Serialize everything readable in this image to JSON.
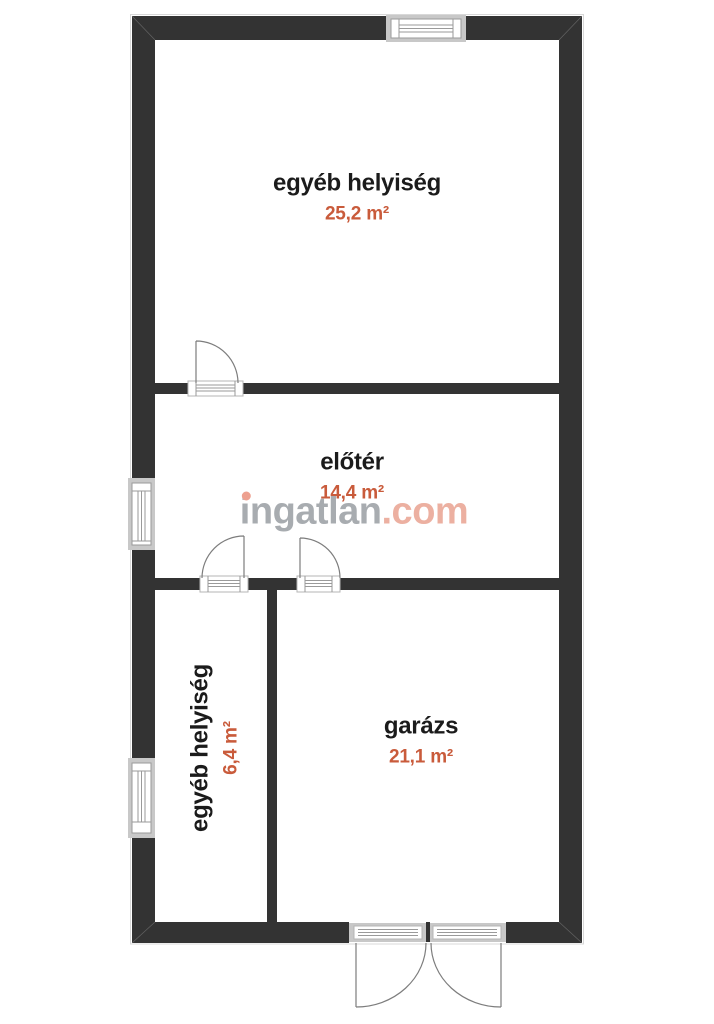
{
  "watermark": {
    "name": "ingatlan",
    "dot": ".",
    "tld": "com"
  },
  "rooms": [
    {
      "name": "egyéb helyiség",
      "area": "25,2 m²"
    },
    {
      "name": "előtér",
      "area": "14,4 m²"
    },
    {
      "name": "egyéb helyiség",
      "area": "6,4 m²"
    },
    {
      "name": "garázs",
      "area": "21,1 m²"
    }
  ],
  "colors": {
    "wall": "#333333",
    "accent": "#c95b3b",
    "room_label": "#1b1b1b",
    "watermark_text": "#a8acb0",
    "watermark_accent": "#ecb0a1",
    "watermark_dot": "#eda08f",
    "window_frame": "#c8c8c8",
    "symbol_line": "#9a9a9a",
    "sill_border": "#b5b5b5",
    "arc_line": "#7d7d7d"
  }
}
